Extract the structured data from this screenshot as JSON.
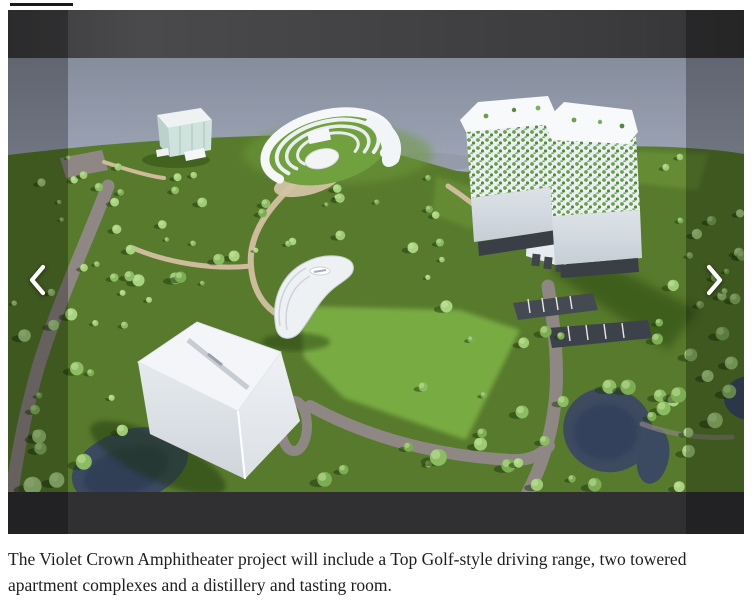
{
  "article": {
    "caption": "The Violet Crown Amphitheater project will include a Top Golf-style driving range, two towered apartment complexes and a distillery and tasting room."
  },
  "carousel": {
    "image_description": "Aerial architectural rendering of a green park campus with an amphitheater, a large white driving-range building, a curved building, ponds and two plant-covered apartment towers",
    "prev_label": "Previous slide",
    "next_label": "Next slide",
    "icons": {
      "prev": "chevron-left-icon",
      "next": "chevron-right-icon"
    }
  },
  "colors": {
    "page_bg": "#ffffff",
    "carousel_bg": "#39393b",
    "letterbox_bottom": "#303032",
    "dim_overlay": "rgba(0,0,0,0.28)",
    "arrow": "#ffffff",
    "caption_text": "#1d1d1d",
    "top_rule": "#1a1a1a",
    "sky_top": "#868d9d",
    "sky_horizon": "#a9b1c2",
    "grass": "#587a2c",
    "grass_light": "#7eb247",
    "road": "#8e8784",
    "path": "#cdbc9b",
    "water": "#3e4a60",
    "building_white": "#f3f5f8",
    "tree_greens": [
      "#9dca72",
      "#8cbc61",
      "#7cad52",
      "#a8d37f"
    ]
  }
}
